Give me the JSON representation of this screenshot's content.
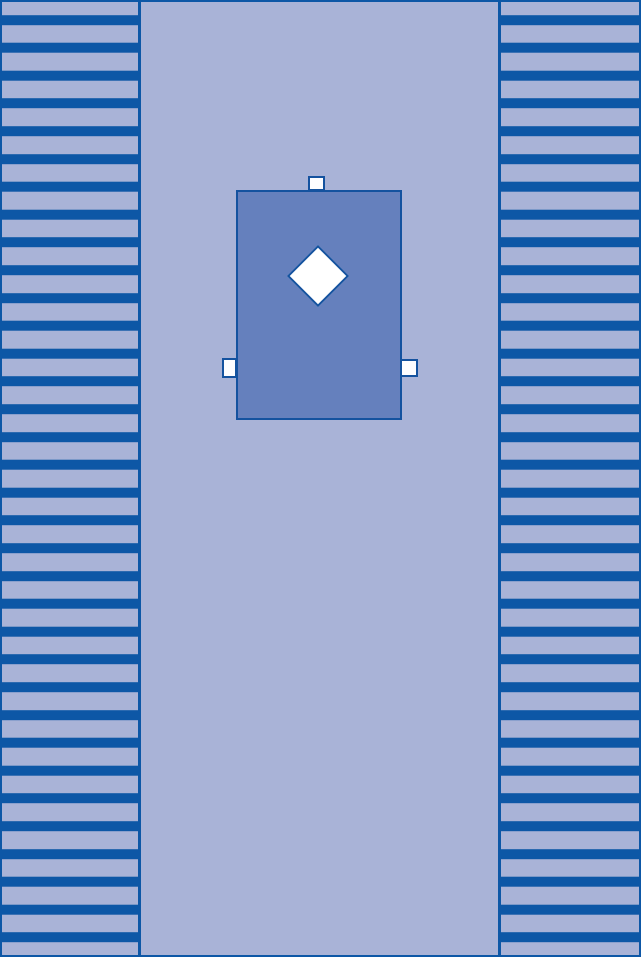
{
  "colors": {
    "canvas_bg": "#a9b3d7",
    "stripe_dark": "#0d57a6",
    "outline_dark": "#14529f",
    "patch_fill": "#6580bd",
    "tab_fill": "#fdfdff",
    "diamond_fill": "#ffffff"
  },
  "shapes": {
    "left_strip": "pleated-striped-strip",
    "right_strip": "pleated-striped-strip",
    "patch": "solid-rectangle-patch",
    "diamond": "diamond-cutout-shape",
    "tab_top": "small-white-tab",
    "tab_left": "small-white-tab",
    "tab_right": "small-white-tab"
  }
}
